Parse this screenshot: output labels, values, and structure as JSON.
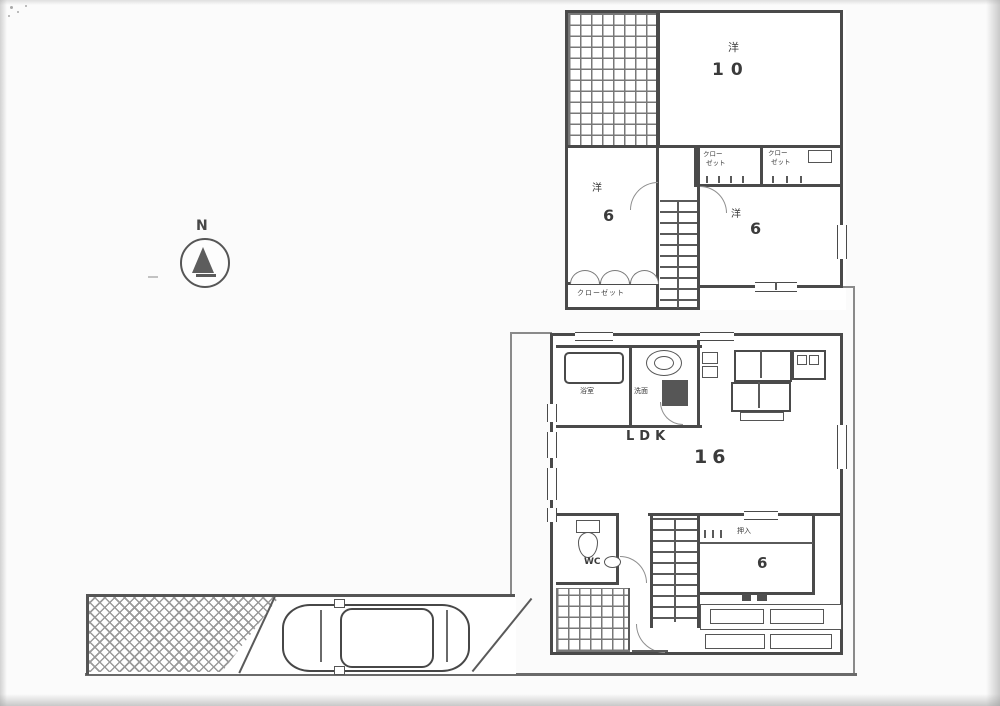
{
  "compass": {
    "north": "N"
  },
  "floor2": {
    "room_large": {
      "type": "洋",
      "size": "10"
    },
    "closet_left": {
      "l1": "クロー",
      "l2": "ゼット"
    },
    "closet_right": {
      "l1": "クロー",
      "l2": "ゼット"
    },
    "room_left": {
      "type": "洋",
      "size": "6"
    },
    "room_right": {
      "type": "洋",
      "size": "6"
    },
    "closet_bottom": {
      "label": "クローゼット"
    }
  },
  "floor1": {
    "bathroom": {
      "label": "浴室"
    },
    "washroom": {
      "label": "洗面"
    },
    "ldk": {
      "label": "LDK",
      "size": "16"
    },
    "wc": {
      "label": "WC"
    },
    "closet": {
      "label": "押入"
    },
    "room": {
      "size": "6"
    }
  }
}
